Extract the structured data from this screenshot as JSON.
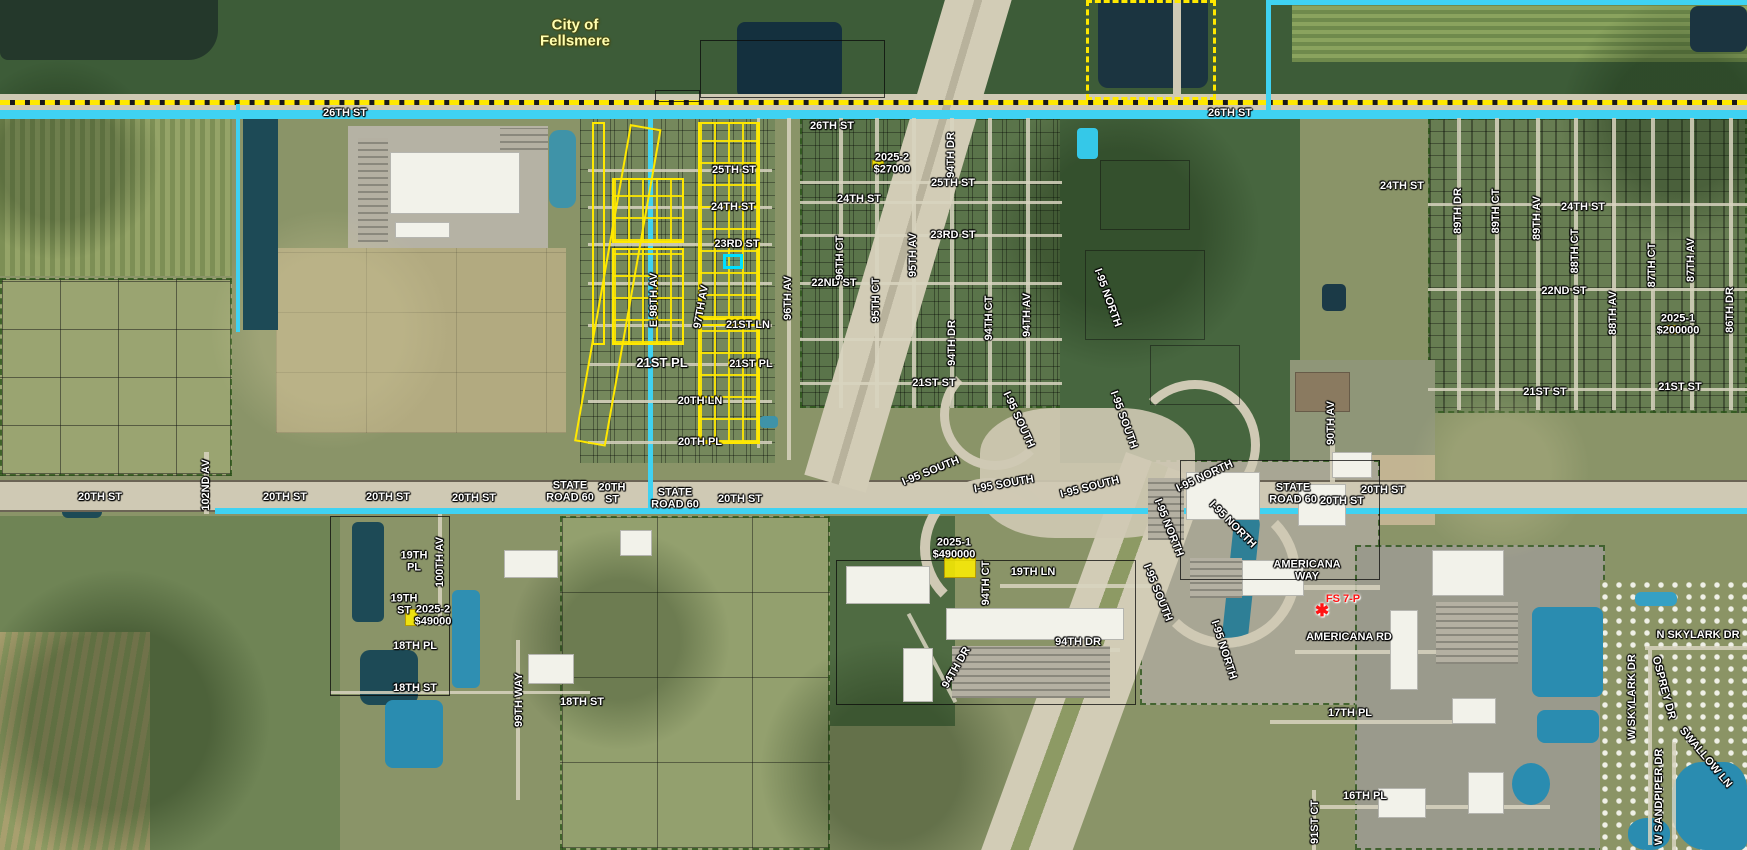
{
  "map": {
    "description": "Aerial GIS parcel map with highlighted subdivision and sale annotations",
    "city_boundary_label": "City of Fellsmere",
    "colors": {
      "road_highlight_cyan": "#3FD2F2",
      "city_boundary_yellow": "#FFE800",
      "highlight_parcel_yellow": "#FFF000",
      "selected_parcel_cyan": "#00E0FF",
      "label_white": "#FFFFFF",
      "fire_station_red": "#FF1414",
      "city_label_cream": "#FFFFB0",
      "water_dark": "#1C4353",
      "water_blue": "#2F8FB2"
    },
    "selected_parcel": {
      "x": 723,
      "y": 254,
      "w": 20,
      "h": 15
    },
    "sale_highlights": [
      {
        "x": 944,
        "y": 552,
        "w": 32,
        "h": 26
      },
      {
        "x": 405,
        "y": 609,
        "w": 13,
        "h": 17
      },
      {
        "x": 1664,
        "y": 325,
        "w": 13,
        "h": 9
      },
      {
        "x": 872,
        "y": 160,
        "w": 12,
        "h": 8
      }
    ],
    "poi_star": {
      "label": "FS 7-P",
      "x": 1322,
      "y": 611,
      "glyph": "✱"
    },
    "labels": [
      {
        "t": "City of\nFellsmere",
        "x": 575,
        "y": 33,
        "s": 15,
        "c": "cream",
        "k": "city"
      },
      {
        "t": "26TH ST",
        "x": 345,
        "y": 114
      },
      {
        "t": "26TH ST",
        "x": 832,
        "y": 127
      },
      {
        "t": "26TH ST",
        "x": 1230,
        "y": 114
      },
      {
        "t": "25TH ST",
        "x": 734,
        "y": 171
      },
      {
        "t": "25TH ST",
        "x": 953,
        "y": 184
      },
      {
        "t": "24TH ST",
        "x": 733,
        "y": 208
      },
      {
        "t": "24TH ST",
        "x": 859,
        "y": 200
      },
      {
        "t": "24TH ST",
        "x": 1402,
        "y": 187
      },
      {
        "t": "24TH ST",
        "x": 1583,
        "y": 208
      },
      {
        "t": "23RD ST",
        "x": 737,
        "y": 245
      },
      {
        "t": "23RD ST",
        "x": 953,
        "y": 236
      },
      {
        "t": "22ND ST",
        "x": 834,
        "y": 284
      },
      {
        "t": "22ND ST",
        "x": 1564,
        "y": 292
      },
      {
        "t": "21ST LN",
        "x": 748,
        "y": 326
      },
      {
        "t": "21ST PL",
        "x": 662,
        "y": 363,
        "s": 13
      },
      {
        "t": "21ST PL",
        "x": 751,
        "y": 365
      },
      {
        "t": "21ST ST",
        "x": 934,
        "y": 384
      },
      {
        "t": "21ST ST",
        "x": 1545,
        "y": 393
      },
      {
        "t": "21ST ST",
        "x": 1680,
        "y": 388
      },
      {
        "t": "20TH LN",
        "x": 700,
        "y": 402
      },
      {
        "t": "20TH PL",
        "x": 700,
        "y": 443
      },
      {
        "t": "20TH ST",
        "x": 100,
        "y": 498
      },
      {
        "t": "20TH ST",
        "x": 285,
        "y": 498
      },
      {
        "t": "20TH ST",
        "x": 388,
        "y": 498
      },
      {
        "t": "20TH ST",
        "x": 474,
        "y": 499
      },
      {
        "t": "STATE\nROAD 60",
        "x": 570,
        "y": 492
      },
      {
        "t": "20TH\nST",
        "x": 612,
        "y": 494
      },
      {
        "t": "STATE\nROAD 60",
        "x": 675,
        "y": 499
      },
      {
        "t": "20TH ST",
        "x": 740,
        "y": 500
      },
      {
        "t": "STATE\nROAD 60",
        "x": 1293,
        "y": 494
      },
      {
        "t": "20TH ST",
        "x": 1342,
        "y": 502
      },
      {
        "t": "20TH ST",
        "x": 1383,
        "y": 491
      },
      {
        "t": "19TH\nPL",
        "x": 414,
        "y": 562
      },
      {
        "t": "19TH\nST",
        "x": 404,
        "y": 605
      },
      {
        "t": "18TH PL",
        "x": 415,
        "y": 647
      },
      {
        "t": "18TH ST",
        "x": 415,
        "y": 689
      },
      {
        "t": "18TH ST",
        "x": 582,
        "y": 703
      },
      {
        "t": "19TH LN",
        "x": 1033,
        "y": 573
      },
      {
        "t": "94TH DR",
        "x": 1078,
        "y": 643
      },
      {
        "t": "AMERICANA\nWAY",
        "x": 1307,
        "y": 571
      },
      {
        "t": "AMERICANA RD",
        "x": 1349,
        "y": 638
      },
      {
        "t": "FS 7-P",
        "x": 1343,
        "y": 600,
        "c": "red",
        "k": "poi"
      },
      {
        "t": "N SKYLARK DR",
        "x": 1698,
        "y": 636
      },
      {
        "t": "17TH PL",
        "x": 1350,
        "y": 714
      },
      {
        "t": "16TH PL",
        "x": 1365,
        "y": 797
      },
      {
        "t": "2025-2\n$27000",
        "x": 892,
        "y": 164,
        "k": "sale"
      },
      {
        "t": "2025-2\n$49000",
        "x": 433,
        "y": 616,
        "k": "sale"
      },
      {
        "t": "2025-1\n$490000",
        "x": 954,
        "y": 549,
        "k": "sale"
      },
      {
        "t": "2025-1\n$200000",
        "x": 1678,
        "y": 325,
        "k": "sale"
      },
      {
        "t": "102ND AV",
        "x": 207,
        "y": 485,
        "r": -90
      },
      {
        "t": "100TH AV",
        "x": 441,
        "y": 562,
        "r": -90
      },
      {
        "t": "99TH WAY",
        "x": 520,
        "y": 700,
        "r": -90
      },
      {
        "t": "E 98TH AV",
        "x": 655,
        "y": 300,
        "r": -90
      },
      {
        "t": "97TH AV",
        "x": 702,
        "y": 307,
        "r": -80
      },
      {
        "t": "96TH AV",
        "x": 789,
        "y": 298,
        "r": -90
      },
      {
        "t": "96TH CT",
        "x": 841,
        "y": 258,
        "r": -90
      },
      {
        "t": "95TH AV",
        "x": 914,
        "y": 255,
        "r": -90
      },
      {
        "t": "95TH CT",
        "x": 877,
        "y": 300,
        "r": -90
      },
      {
        "t": "94TH DR",
        "x": 952,
        "y": 155,
        "r": -90
      },
      {
        "t": "94TH DR",
        "x": 953,
        "y": 343,
        "r": -90
      },
      {
        "t": "94TH CT",
        "x": 990,
        "y": 318,
        "r": -90
      },
      {
        "t": "94TH AV",
        "x": 1028,
        "y": 315,
        "r": -90
      },
      {
        "t": "94TH CT",
        "x": 987,
        "y": 583,
        "r": -90
      },
      {
        "t": "94TH DR",
        "x": 957,
        "y": 668,
        "r": -60
      },
      {
        "t": "90TH AV",
        "x": 1332,
        "y": 423,
        "r": -90
      },
      {
        "t": "91ST CT",
        "x": 1316,
        "y": 822,
        "r": -90
      },
      {
        "t": "89TH DR",
        "x": 1459,
        "y": 211,
        "r": -90
      },
      {
        "t": "89TH CT",
        "x": 1497,
        "y": 211,
        "r": -90
      },
      {
        "t": "89TH AV",
        "x": 1538,
        "y": 218,
        "r": -90
      },
      {
        "t": "88TH CT",
        "x": 1576,
        "y": 251,
        "r": -90
      },
      {
        "t": "88TH AV",
        "x": 1614,
        "y": 313,
        "r": -90
      },
      {
        "t": "87TH CT",
        "x": 1653,
        "y": 265,
        "r": -90
      },
      {
        "t": "87TH AV",
        "x": 1692,
        "y": 260,
        "r": -90
      },
      {
        "t": "86TH DR",
        "x": 1731,
        "y": 310,
        "r": -90
      },
      {
        "t": "W SKYLARK DR",
        "x": 1633,
        "y": 697,
        "r": -90
      },
      {
        "t": "W SANDPIPER DR",
        "x": 1660,
        "y": 797,
        "r": -90
      },
      {
        "t": "OSPREY DR",
        "x": 1663,
        "y": 688,
        "r": 75
      },
      {
        "t": "SWALLOW LN",
        "x": 1705,
        "y": 758,
        "r": 50
      },
      {
        "t": "I-95 NORTH",
        "x": 1107,
        "y": 298,
        "r": 70,
        "k": "hwy"
      },
      {
        "t": "I-95 SOUTH",
        "x": 1123,
        "y": 420,
        "r": 70,
        "k": "hwy"
      },
      {
        "t": "I-95 SOUTH",
        "x": 1018,
        "y": 420,
        "r": 65,
        "k": "hwy"
      },
      {
        "t": "I-95 SOUTH",
        "x": 931,
        "y": 472,
        "r": -22,
        "k": "hwy"
      },
      {
        "t": "I-95 SOUTH",
        "x": 1004,
        "y": 485,
        "r": -10,
        "k": "hwy"
      },
      {
        "t": "I-95 SOUTH",
        "x": 1090,
        "y": 488,
        "r": -14,
        "k": "hwy"
      },
      {
        "t": "I-95 NORTH",
        "x": 1205,
        "y": 477,
        "r": -25,
        "k": "hwy"
      },
      {
        "t": "I-95 NORTH",
        "x": 1168,
        "y": 528,
        "r": 68,
        "k": "hwy"
      },
      {
        "t": "I-95 NORTH",
        "x": 1232,
        "y": 525,
        "r": 45,
        "k": "hwy"
      },
      {
        "t": "I-95 SOUTH",
        "x": 1157,
        "y": 593,
        "r": 68,
        "k": "hwy"
      },
      {
        "t": "I-95 NORTH",
        "x": 1223,
        "y": 650,
        "r": 72,
        "k": "hwy"
      }
    ]
  }
}
